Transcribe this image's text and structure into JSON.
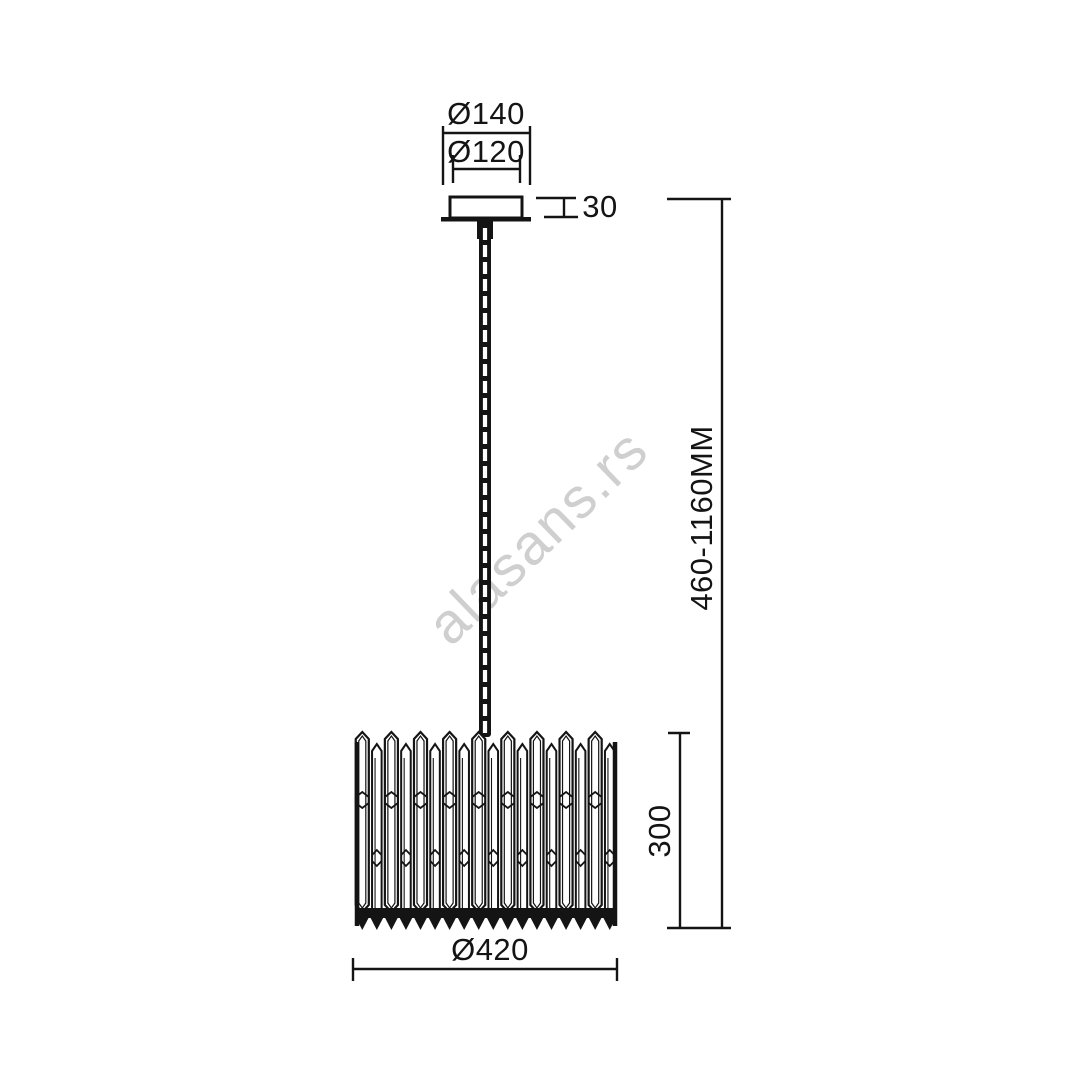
{
  "figure": {
    "kind": "pendant-lamp-dimension-drawing"
  },
  "watermark": {
    "text": "alasans.rs"
  },
  "dimension_labels": {
    "canopy_outer_diameter": "Ø140",
    "canopy_inner_diameter": "Ø120",
    "canopy_height": "30",
    "suspension_height_range": "460-1160MM",
    "shade_height": "300",
    "shade_diameter": "Ø420"
  },
  "colors": {
    "line": "#141414",
    "background": "#ffffff",
    "watermark": "#cfcfcf"
  }
}
